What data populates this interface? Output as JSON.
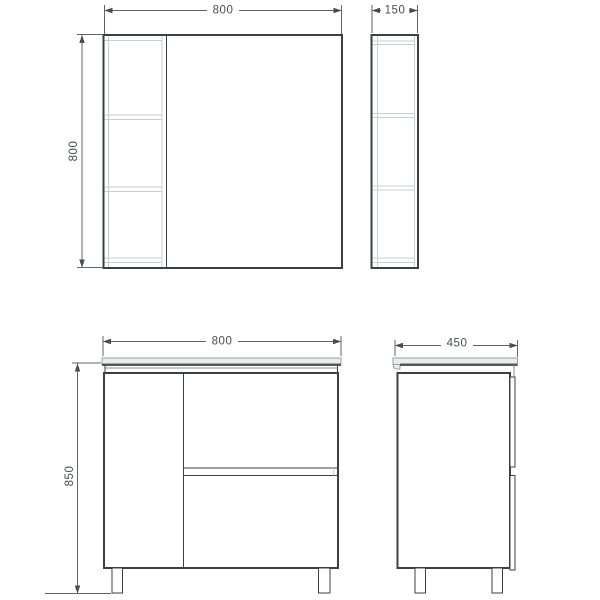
{
  "drawing": {
    "type": "technical-dimension-diagram",
    "subject": "bathroom vanity unit with mirror shaving cabinet",
    "background": "#ffffff",
    "line_color_dark": "#3d4042",
    "line_color_light": "#c9ced1",
    "dimension_color": "#5f6366",
    "countertop_fill": "#ececec",
    "views": {
      "mirror_cabinet_front": {
        "title": "mirror cabinet front view",
        "width_mm": "800",
        "height_mm": "800"
      },
      "mirror_cabinet_side": {
        "title": "mirror cabinet side view",
        "depth_mm": "150"
      },
      "vanity_front": {
        "title": "vanity cabinet front view",
        "width_mm": "800",
        "height_mm": "850"
      },
      "vanity_side": {
        "title": "vanity cabinet side view",
        "depth_mm": "450"
      }
    }
  }
}
